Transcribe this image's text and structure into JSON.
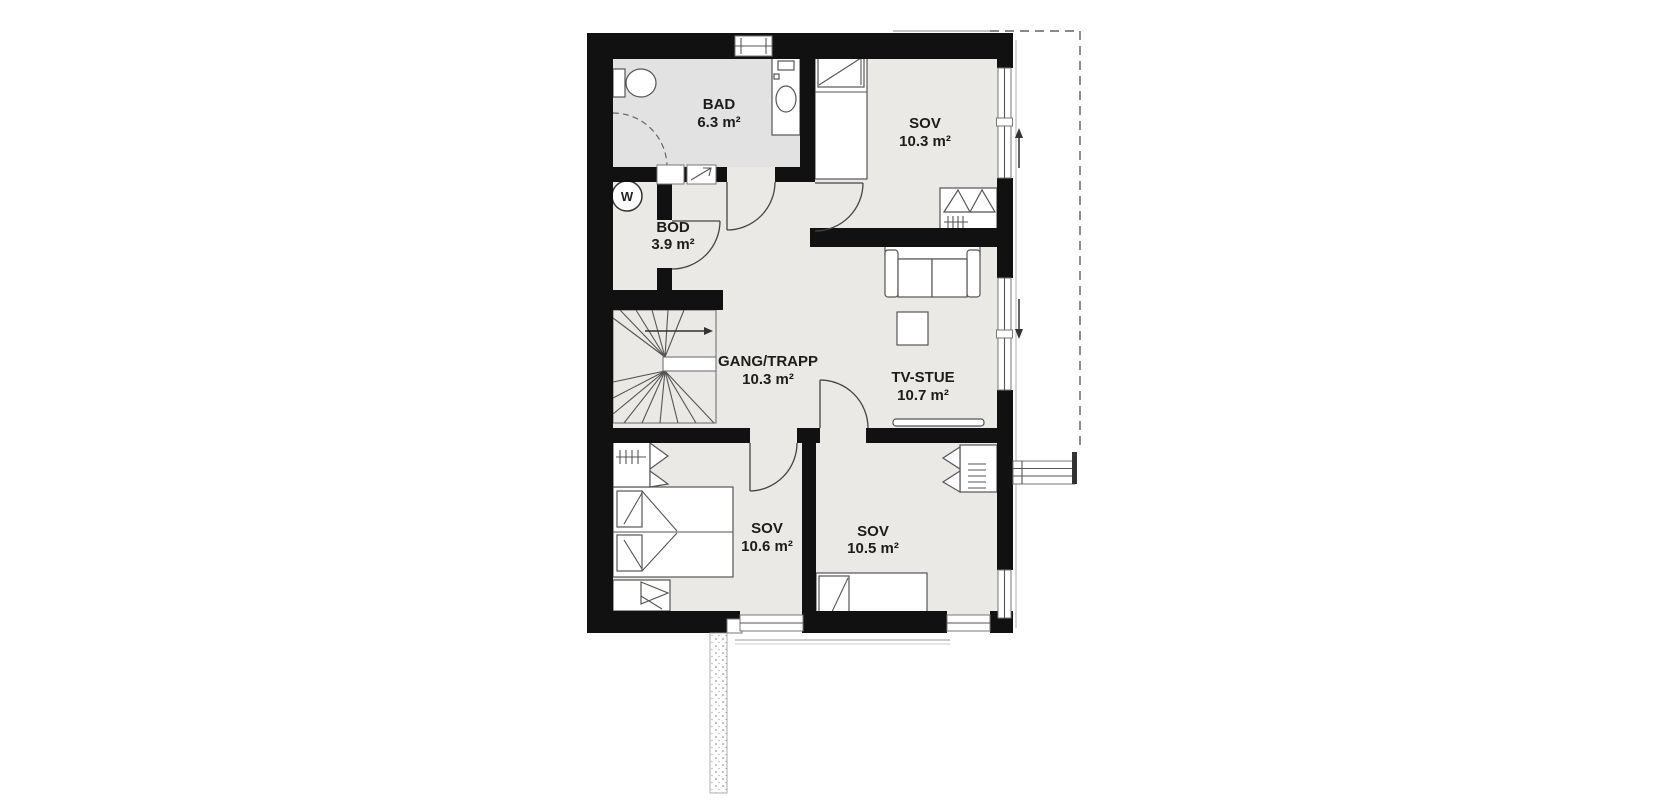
{
  "rooms": [
    {
      "name": "BAD",
      "area": "6.3 m²"
    },
    {
      "name": "SOV",
      "area": "10.3 m²"
    },
    {
      "name": "BOD",
      "area": "3.9 m²"
    },
    {
      "name": "GANG/TRAPP",
      "area": "10.3 m²"
    },
    {
      "name": "TV-STUE",
      "area": "10.7 m²"
    },
    {
      "name": "SOV",
      "area": "10.6 m²"
    },
    {
      "name": "SOV",
      "area": "10.5 m²"
    }
  ],
  "symbols": {
    "water_heater": "W"
  },
  "colors": {
    "wall": "#111111",
    "floor": "#ebe9e5",
    "bathroom_floor": "#e2e2e2",
    "furniture_line": "#555555",
    "label_text": "#1c1c1c"
  }
}
